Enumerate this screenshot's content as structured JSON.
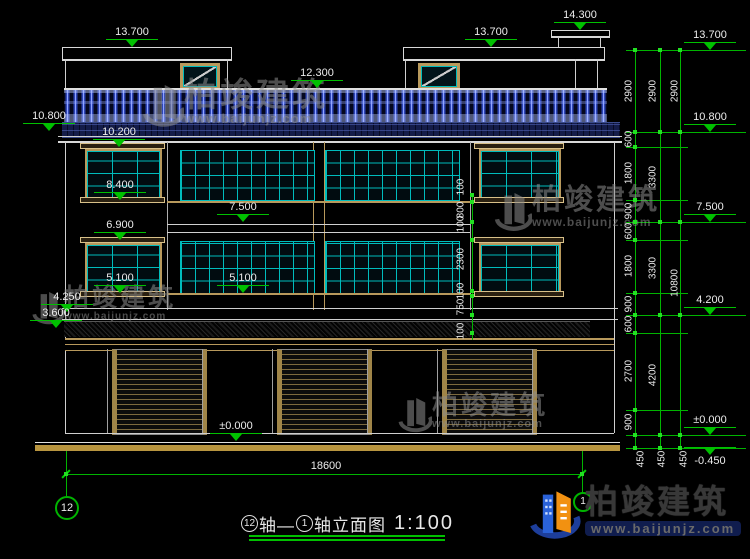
{
  "colors": {
    "dim_green": "#00b400",
    "text": "#ececec",
    "frame_tan": "#b8995c",
    "mullion_cyan": "#00bcbc",
    "baluster_blue": "#2e46b8",
    "ground_tan": "#b8953f"
  },
  "elev": {
    "roof_left": "13.700",
    "bulkhead": "14.300",
    "roof_right": "13.700",
    "terrace": "12.300",
    "left_cornice": "10.800",
    "win3_head": "10.200",
    "win3_sill": "8.400",
    "floor3": "7.500",
    "win2_head": "6.900",
    "win2_sill_left": "5.100",
    "win2_sill_mid": "5.100",
    "ledge_top": "4.250",
    "ledge_bottom": "3.600",
    "ground": "±0.000",
    "r_roof": "13.700",
    "r_cornice": "10.800",
    "r_floor3": "7.500",
    "r_ledge": "4.200",
    "r_ground": "±0.000",
    "r_base": "-0.450"
  },
  "dims": {
    "r1": [
      "2900",
      "600",
      "1800",
      "900",
      "600",
      "1800",
      "900",
      "600",
      "2700",
      "900",
      "450"
    ],
    "r2": [
      "2900",
      "3300",
      "3300",
      "4200",
      "450"
    ],
    "r3": [
      "2900",
      "10800",
      "450"
    ],
    "mid": [
      "100",
      "800",
      "100",
      "2300",
      "100",
      "750",
      "100"
    ],
    "total_width": "18600"
  },
  "axes": {
    "left": "12",
    "right": "1"
  },
  "title": {
    "axis_a": "12",
    "sep": "轴—",
    "axis_b": "1",
    "name": "轴立面图",
    "scale": "1:100"
  },
  "watermark": {
    "brand": "柏竣建筑",
    "url": "www.baijunjz.com"
  },
  "footer": {
    "brand": "柏竣建筑",
    "url": "www.baijunjz.com"
  }
}
